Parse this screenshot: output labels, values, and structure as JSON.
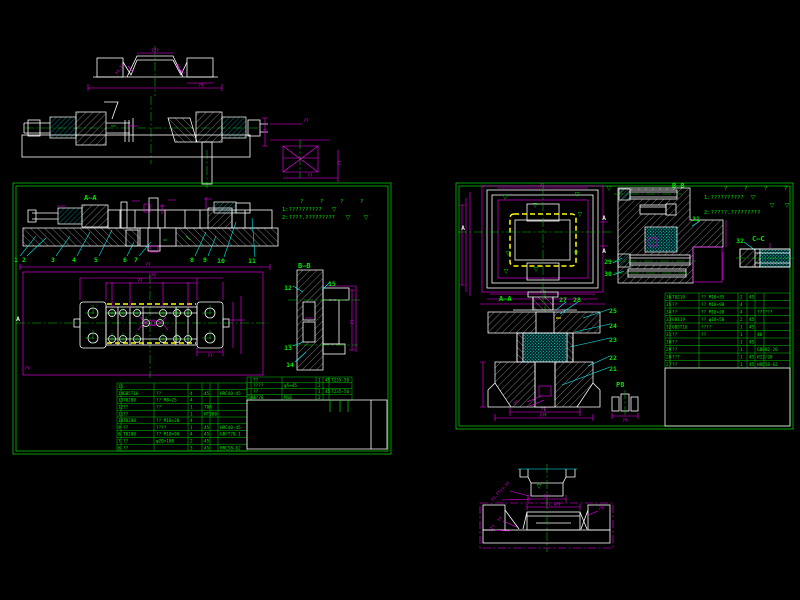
{
  "colors": {
    "background": "#000000",
    "line_green": "#00e000",
    "line_magenta": "#ff00ff",
    "line_cyan": "#00ffff",
    "line_white": "#ffffff",
    "line_yellow": "#ffff00"
  },
  "misc": {
    "tri": "▽",
    "dim2": "??",
    "dim3": "???",
    "dim4": "??.??",
    "dim5": "??.???"
  },
  "left_sheet": {
    "labels": {
      "section_top": "A—A",
      "section_side": "B—B",
      "plan_marker": "A"
    },
    "notes": {
      "marks": [
        "?",
        "?",
        "?",
        "?"
      ],
      "line1": "1:??????????",
      "line2": "2:????.?????????"
    },
    "balloons_main": [
      "1",
      "2",
      "3",
      "4",
      "5",
      "6",
      "7",
      "8",
      "9"
    ],
    "balloons_upper": [
      "10",
      "11"
    ],
    "balloons_side": [
      "12",
      "13",
      "14",
      "15"
    ],
    "table_main": {
      "rows": [
        [
          "15",
          "",
          "",
          "",
          "",
          ""
        ],
        [
          "14",
          "GB5T16",
          "??",
          "4",
          "45",
          "HRC40-45"
        ],
        [
          "13",
          "T8200",
          "?? M8×25",
          "4",
          "",
          ""
        ],
        [
          "12",
          "??",
          "??",
          "1",
          "T8A",
          ""
        ],
        [
          "11",
          "??",
          "",
          "1",
          "HT200",
          ""
        ],
        [
          "10",
          "T8200",
          "?? M10×20",
          "4",
          "",
          ""
        ],
        [
          "9",
          "??",
          "????",
          "1",
          "45",
          "HRC40-45"
        ],
        [
          "8",
          "T8200",
          "?? M10×90",
          "4",
          "45",
          "GB/T70.1"
        ],
        [
          "7",
          "??",
          "φ20×100",
          "2",
          "45",
          ""
        ],
        [
          "6",
          "??",
          "",
          "3",
          "45",
          "HRC58-62"
        ]
      ]
    },
    "table_aux": {
      "rows": [
        [
          "",
          "??",
          "",
          "1",
          "45",
          "T235-50"
        ],
        [
          "",
          "????",
          "φ5×45",
          "2",
          "",
          ""
        ],
        [
          "",
          "??",
          "",
          "1",
          "45",
          "T235-50"
        ],
        [
          "280 78",
          "??",
          "M10",
          "2",
          "",
          ""
        ]
      ]
    }
  },
  "right_sheet": {
    "labels": {
      "section_b": "B—B",
      "section_a": "A—A",
      "section_c": "C—C",
      "marker_a": "A",
      "detail": "P8"
    },
    "notes": {
      "marks": [
        "?",
        "?",
        "?",
        "?"
      ],
      "line1": "1:??????????",
      "line2": "2:?????.?????????"
    },
    "balloons_b": [
      "29",
      "30",
      "31",
      "32"
    ],
    "balloons_a_top": [
      "27",
      "28"
    ],
    "balloons_a_right": [
      "25",
      "24",
      "23",
      "22",
      "21"
    ],
    "table": {
      "rows": [
        [
          "36",
          "T8210",
          "?? M10×35",
          "2",
          "45",
          ""
        ],
        [
          "35",
          "??",
          "?? M10×90",
          "4",
          "",
          ""
        ],
        [
          "34",
          "??",
          "?? M10×28",
          "4",
          "",
          "??????"
        ],
        [
          "33",
          "GB119",
          "?? φ10×50",
          "2",
          "45",
          ""
        ],
        [
          "32",
          "GB5T16",
          "????",
          "1",
          "45",
          ""
        ],
        [
          "31",
          "??",
          "??",
          "1",
          "",
          "40"
        ],
        [
          "30",
          "??",
          "",
          "1",
          "45",
          ""
        ],
        [
          "29",
          "??",
          "",
          "1",
          "",
          "GB882-20"
        ],
        [
          "28",
          "???",
          "",
          "1",
          "45",
          "H13/20"
        ],
        [
          "27",
          "??",
          "",
          "1",
          "45",
          "HRC58-62"
        ]
      ]
    }
  }
}
